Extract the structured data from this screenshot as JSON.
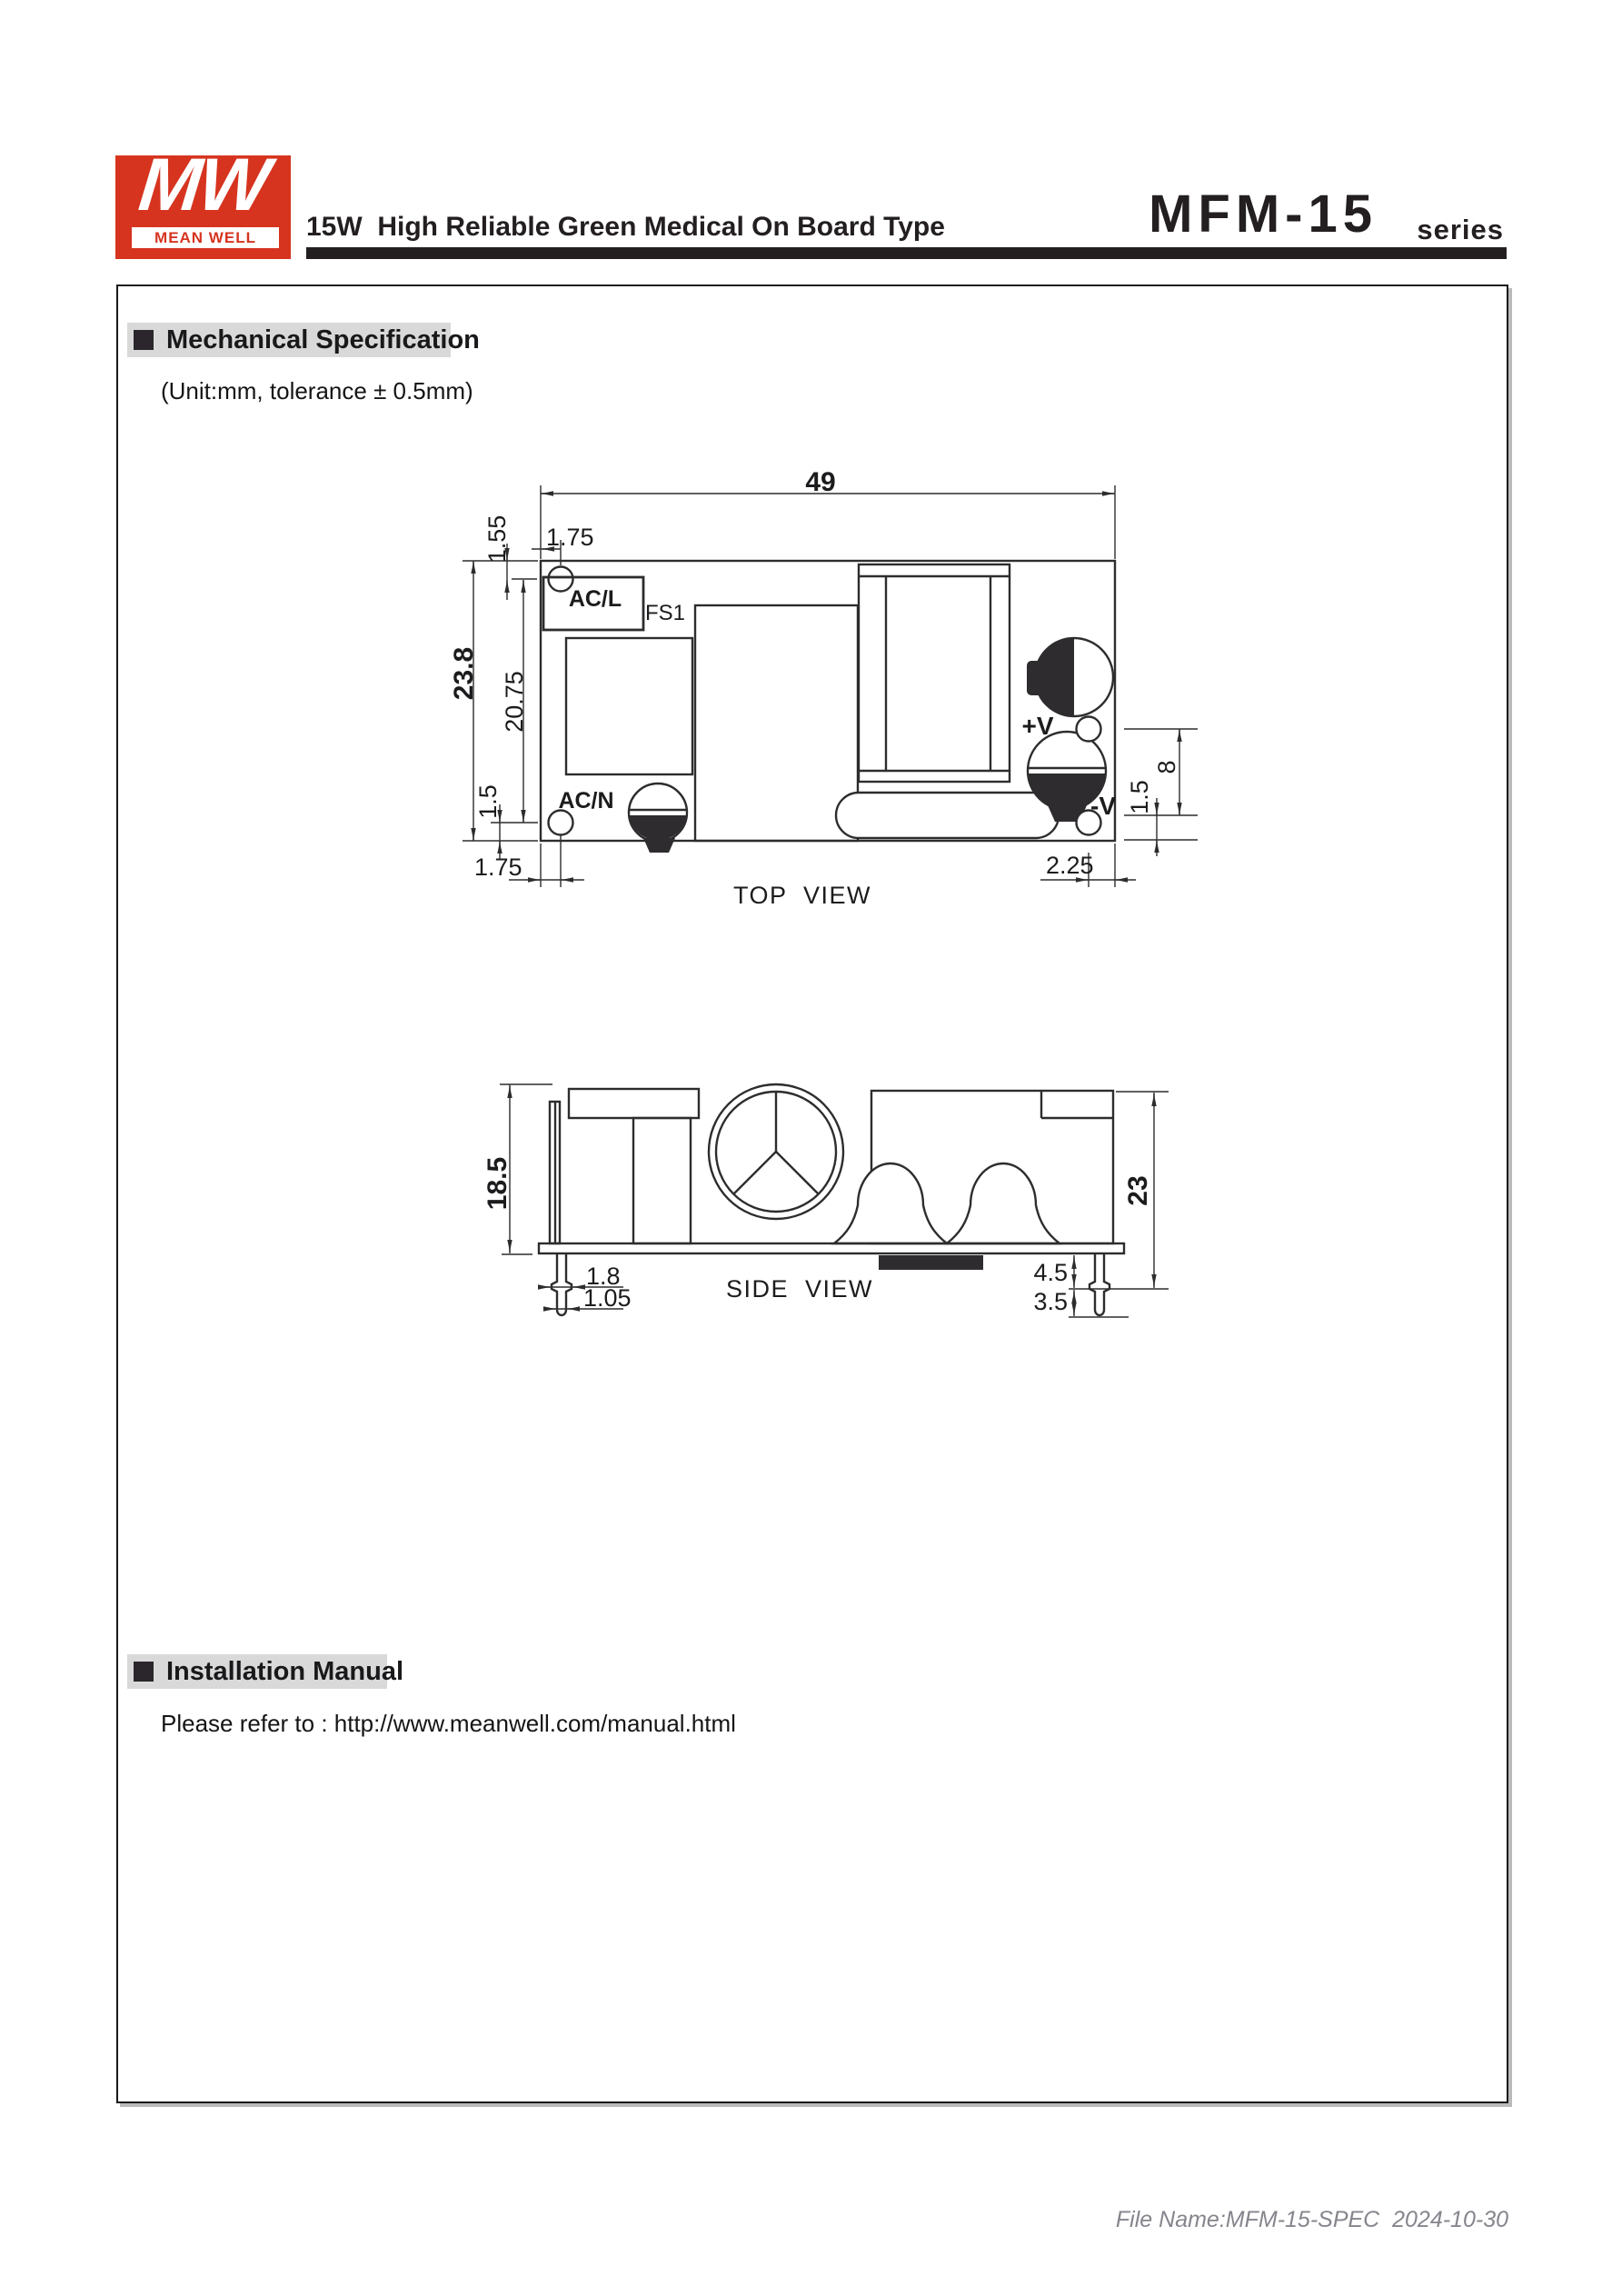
{
  "header": {
    "logo": {
      "monogram": "MW",
      "brand": "MEAN WELL"
    },
    "title": "15W  High Reliable Green Medical On Board Type",
    "series": {
      "model": "MFM-15",
      "suffix": "series"
    }
  },
  "mechanical_section": {
    "heading": "Mechanical Specification",
    "unit_note": "(Unit:mm, tolerance ± 0.5mm)"
  },
  "installation_section": {
    "heading": "Installation Manual",
    "note": "Please refer to : http://www.meanwell.com/manual.html"
  },
  "top_view": {
    "caption": "TOP  VIEW",
    "labels": {
      "fuse": "AC/L",
      "fuse_ref": "FS1",
      "ac_neutral": "AC/N",
      "v_plus": "+V",
      "v_minus": "-V"
    },
    "dims": {
      "board_width": "49",
      "board_height": "23.8",
      "hole_top_offset": "1.55",
      "hole_left_offset": "1.75",
      "hole_span": "20.75",
      "hole_bottom_offset": "1.5",
      "bottom_hole_left_offset": "1.75",
      "output_hole_span": "8",
      "output_hole_bottom_offset": "1.5",
      "output_hole_right_offset": "2.25"
    }
  },
  "side_view": {
    "caption": "SIDE  VIEW",
    "dims": {
      "component_height": "18.5",
      "overall_height": "23",
      "pin_shoulder_width": "1.8",
      "pin_tip_width": "1.05",
      "pin_shoulder_length": "4.5",
      "pin_tip_length": "3.5"
    }
  },
  "footer": {
    "file_note": "File Name:MFM-15-SPEC  2024-10-30"
  },
  "colors": {
    "brand_red": "#d6341f",
    "ink": "#231f20",
    "drawing_line": "#2e2c2e",
    "section_bar_gray": "#d9d9d9",
    "footer_gray": "#85858d"
  }
}
